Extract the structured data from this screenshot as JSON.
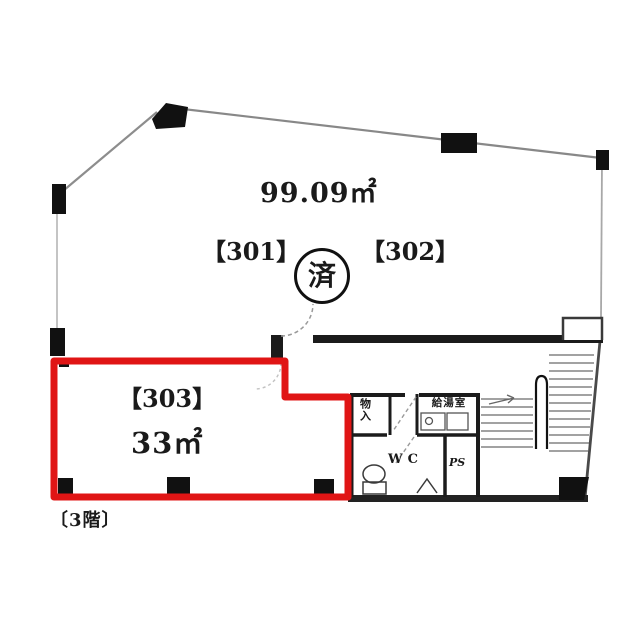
{
  "plan": {
    "floor_label": "〔3階〕",
    "stamp": "済",
    "upper_unit": {
      "area": "99.09㎡",
      "unit_301": "【301】",
      "unit_302": "【302】"
    },
    "unit_303": {
      "label": "【303】",
      "area": "33㎡",
      "outline_color": "#e01515"
    },
    "utility": {
      "storage": "物入",
      "kitchenette": "給湯室",
      "wc": "WC",
      "pipe_space": "PS"
    },
    "colors": {
      "ink": "#1a1a1a",
      "wall": "#222222",
      "highlight": "#e01515",
      "background": "#ffffff"
    }
  }
}
